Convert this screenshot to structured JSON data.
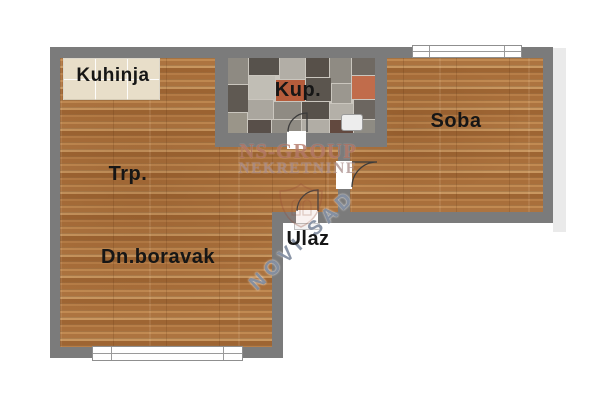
{
  "plan": {
    "rooms": {
      "kitchen": "Kuhinja",
      "bathroom": "Kup.",
      "bedroom": "Soba",
      "dining": "Trp.",
      "living": "Dn.boravak",
      "entrance": "Ulaz"
    },
    "watermark": {
      "brand": "NS-GROUP",
      "type": "NEKRETNINE",
      "city": "NOVI SAD"
    },
    "colors": {
      "wall": "#7b7b7b",
      "wood": "#b27a44",
      "kitchen_tile": "#e8dec9",
      "bath_tile_dark": "#57524c",
      "bath_tile_accent": "#b65c3b",
      "watermark_red": "#9e5442",
      "watermark_blue": "#768298"
    }
  }
}
